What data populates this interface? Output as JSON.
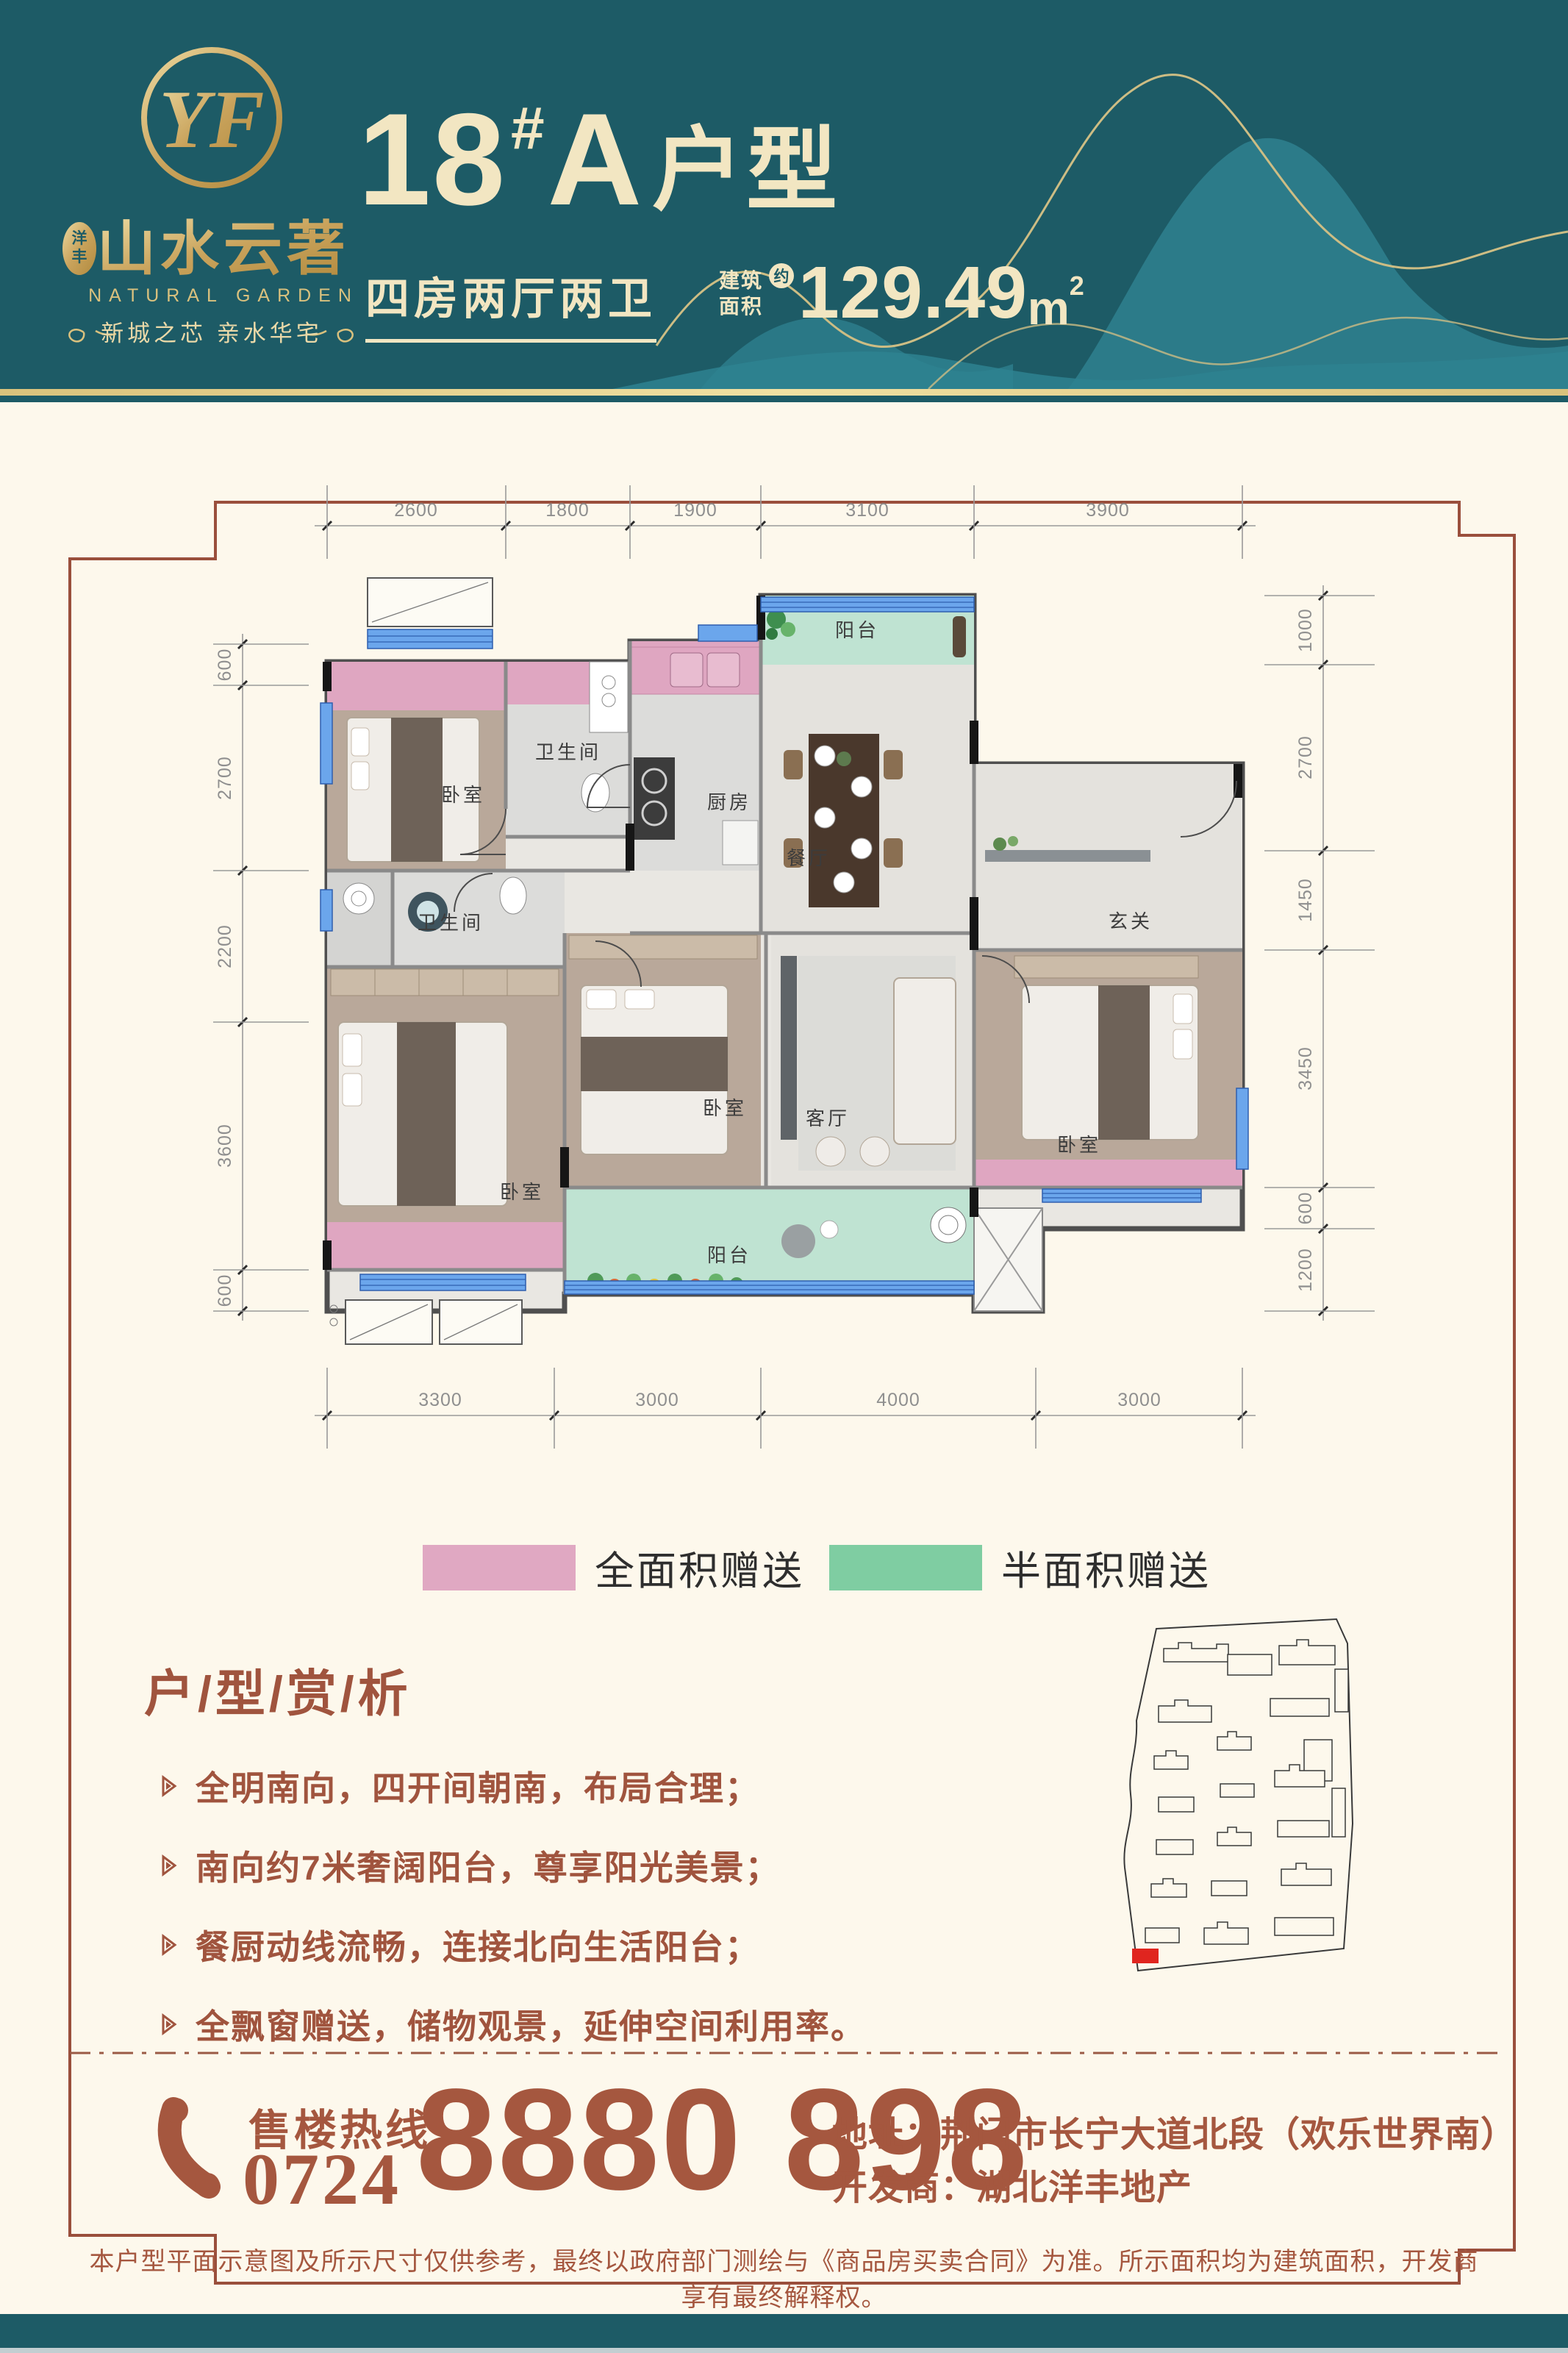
{
  "colors": {
    "teal": "#1d5b66",
    "gold": "#d9c17e",
    "cream": "#fdf8ec",
    "cream_text": "#f2e6c2",
    "brown": "#a0543e",
    "phone_brown": "#a5573f",
    "legend_pink": "#e0a8c2",
    "legend_green": "#7fcda2",
    "plan_pink": "#dfa6c1",
    "plan_green": "#bfe3d2",
    "window_blue": "#6ba6ec",
    "site_highlight": "#e0251f"
  },
  "header": {
    "logo": {
      "monogram": "YF",
      "seal_char1": "洋",
      "seal_char2": "丰",
      "brand_cn": "山水云著",
      "brand_en": "NATURAL GARDEN",
      "slogan": "新城之芯  亲水华宅"
    },
    "title": {
      "number": "18",
      "hash": "#",
      "letter": "A",
      "suffix": "户型"
    },
    "subtitle": "四房两厅两卫",
    "area": {
      "label_line1": "建筑",
      "label_line2": "面积",
      "approx": "约",
      "value": "129.49",
      "unit": "m",
      "sup": "2"
    }
  },
  "plan": {
    "dims": {
      "top": [
        "2600",
        "1800",
        "1900",
        "3100",
        "3900"
      ],
      "left": [
        "600",
        "2700",
        "2200",
        "3600",
        "600"
      ],
      "right": [
        "1000",
        "2700",
        "1450",
        "3450",
        "600",
        "1200"
      ],
      "bottom": [
        "3300",
        "3000",
        "4000",
        "3000"
      ]
    },
    "rooms": {
      "bedroom": "卧室",
      "bathroom": "卫生间",
      "kitchen": "厨房",
      "dining": "餐厅",
      "living": "客厅",
      "entry": "玄关",
      "balcony": "阳台"
    }
  },
  "legend": {
    "full_area": "全面积赠送",
    "half_area": "半面积赠送"
  },
  "analysis": {
    "title": "户/型/赏/析",
    "bullets": [
      "全明南向，四开间朝南，布局合理；",
      "南向约7米奢阔阳台，尊享阳光美景；",
      "餐厨动线流畅，连接北向生活阳台；",
      "全飘窗赠送，储物观景，延伸空间利用率。"
    ]
  },
  "contact": {
    "hotline_label": "售楼热线",
    "area_code": "0724",
    "phone_number": "8880 898",
    "address": "地址：荆门市长宁大道北段（欢乐世界南）",
    "developer": "开发商：湖北洋丰地产"
  },
  "disclaimer": "本户型平面示意图及所示尺寸仅供参考，最终以政府部门测绘与《商品房买卖合同》为准。所示面积均为建筑面积，开发商享有最终解释权。"
}
